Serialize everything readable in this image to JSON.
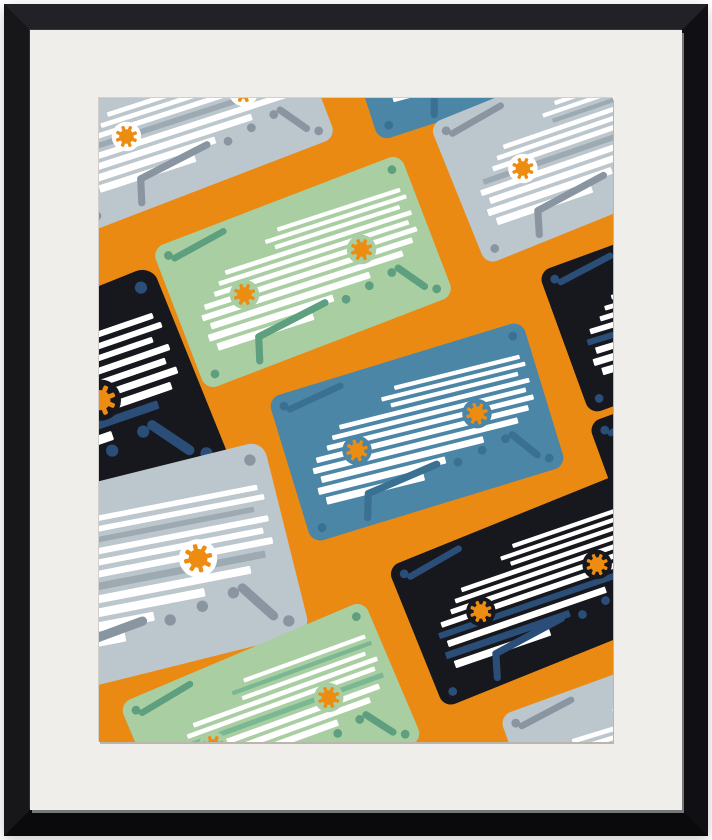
{
  "scene": {
    "page_bg": "#ffffff",
    "description": "Framed wall-art print of retro cassette tapes scattered diagonally on an orange background"
  },
  "frame": {
    "face_top": "#222226",
    "face_left": "#17171a",
    "face_right": "#101014",
    "face_bottom": "#0a0a0d",
    "inner_lip": "#77787a"
  },
  "mat": {
    "color": "#F0EEEB"
  },
  "artwork": {
    "bg": "#EB8A12",
    "aria": "Illustration of tilted cassette tapes in gray, green, blue and black on an orange background"
  },
  "palette": {
    "gear_orange": "#EC8C10",
    "gray": {
      "body": "#BCC6CD",
      "accent": "#8995A0",
      "disc": "#FFFFFF",
      "stripe_accent": "#9EAAB2"
    },
    "green": {
      "body": "#A9CEA2",
      "accent": "#5D9F7E",
      "disc": "#A9CEA2",
      "stripe_accent": "#7AB894"
    },
    "blue": {
      "body": "#4C86A7",
      "accent": "#3A7092",
      "disc": "#4C86A7",
      "stripe_accent": "#86AEC6"
    },
    "black": {
      "body": "#17171E",
      "accent": "#2B4E78",
      "disc": "#17171E",
      "stripe_accent": "#2B4E78"
    }
  },
  "cassette_design": {
    "box": [
      280,
      160
    ],
    "body_radius": 13,
    "render_size": [
      266,
      152
    ],
    "stripe_tilt": 3,
    "stripes": [
      [
        27,
        4.5,
        128,
        264
      ],
      [
        35.5,
        4.5,
        112,
        268
      ],
      [
        44,
        4.5,
        120,
        258
      ],
      [
        53,
        5.0,
        62,
        268
      ],
      [
        62,
        5.0,
        52,
        262
      ],
      [
        71,
        5.5,
        44,
        268
      ],
      [
        80.5,
        6.0,
        30,
        260
      ],
      [
        90.5,
        6.5,
        24,
        246
      ],
      [
        101,
        7.0,
        30,
        206
      ],
      [
        112,
        7.5,
        24,
        162
      ],
      [
        123.5,
        8.0,
        30,
        136
      ]
    ],
    "dash": [
      19,
      18,
      77,
      10
    ],
    "dash_width": 7,
    "screws": [
      [
        14,
        13
      ],
      [
        266,
        13
      ],
      [
        15,
        147
      ],
      [
        265,
        147
      ]
    ],
    "screw_r": 4.6,
    "gear_centers": [
      [
        74,
        80
      ],
      [
        206,
        80
      ]
    ],
    "disc_r": 15.5,
    "cog_r": 7.6,
    "cog_teeth": 8,
    "tooth": [
      3.6,
      4.6
    ],
    "trapezoid_arm": [
      [
        64,
        151
      ],
      [
        72,
        127
      ],
      [
        150,
        118.5
      ]
    ],
    "trapezoid_dots": [
      [
        172,
        123
      ],
      [
        200,
        118.5
      ],
      [
        227,
        114
      ]
    ],
    "trapezoid_dot_r": 4.6,
    "trapezoid_slant": [
      [
        235,
        112
      ],
      [
        254,
        140
      ]
    ],
    "trapezoid_width": 7.5
  },
  "cassettes": [
    {
      "id": "gray-1",
      "type": "gray",
      "cx": 86,
      "cy": 16,
      "rot": -21,
      "scale": 1,
      "accent_rows": [
        3,
        7
      ]
    },
    {
      "id": "blue-0",
      "type": "blue",
      "cx": 383,
      "cy": -70,
      "rot": -18,
      "scale": 1,
      "accent_rows": []
    },
    {
      "id": "gray-2",
      "type": "gray",
      "cx": 482,
      "cy": 47,
      "rot": -22,
      "scale": 1,
      "accent_rows": [
        3,
        7
      ]
    },
    {
      "id": "black-1",
      "type": "black",
      "cx": -80,
      "cy": 335,
      "rot": -22,
      "scale": 1.4,
      "accent_rows": [
        8
      ]
    },
    {
      "id": "green-1",
      "type": "green",
      "cx": 204,
      "cy": 174,
      "rot": -21,
      "scale": 1,
      "accent_rows": []
    },
    {
      "id": "black-2",
      "type": "black",
      "cx": 590,
      "cy": 200,
      "rot": -20,
      "scale": 1,
      "accent_rows": [
        8
      ]
    },
    {
      "id": "blue-1",
      "type": "blue",
      "cx": 318,
      "cy": 334,
      "rot": -17,
      "scale": 1,
      "accent_rows": []
    },
    {
      "id": "gray-3",
      "type": "gray",
      "cx": 20,
      "cy": 480,
      "rot": -14,
      "scale": 1.3,
      "accent_rows": [
        3,
        7
      ]
    },
    {
      "id": "green-2",
      "type": "green",
      "cx": 172,
      "cy": 624,
      "rot": -23,
      "scale": 1,
      "accent_rows": [
        2,
        6
      ]
    },
    {
      "id": "black-3",
      "type": "black",
      "cx": 440,
      "cy": 490,
      "rot": -22,
      "scale": 1,
      "accent_rows": [
        8,
        10
      ]
    },
    {
      "id": "black-4",
      "type": "black",
      "cx": 640,
      "cy": 351,
      "rot": -20,
      "scale": 1,
      "accent_rows": []
    },
    {
      "id": "gray-4",
      "type": "gray",
      "cx": 551,
      "cy": 644,
      "rot": -20,
      "scale": 1,
      "accent_rows": []
    }
  ]
}
